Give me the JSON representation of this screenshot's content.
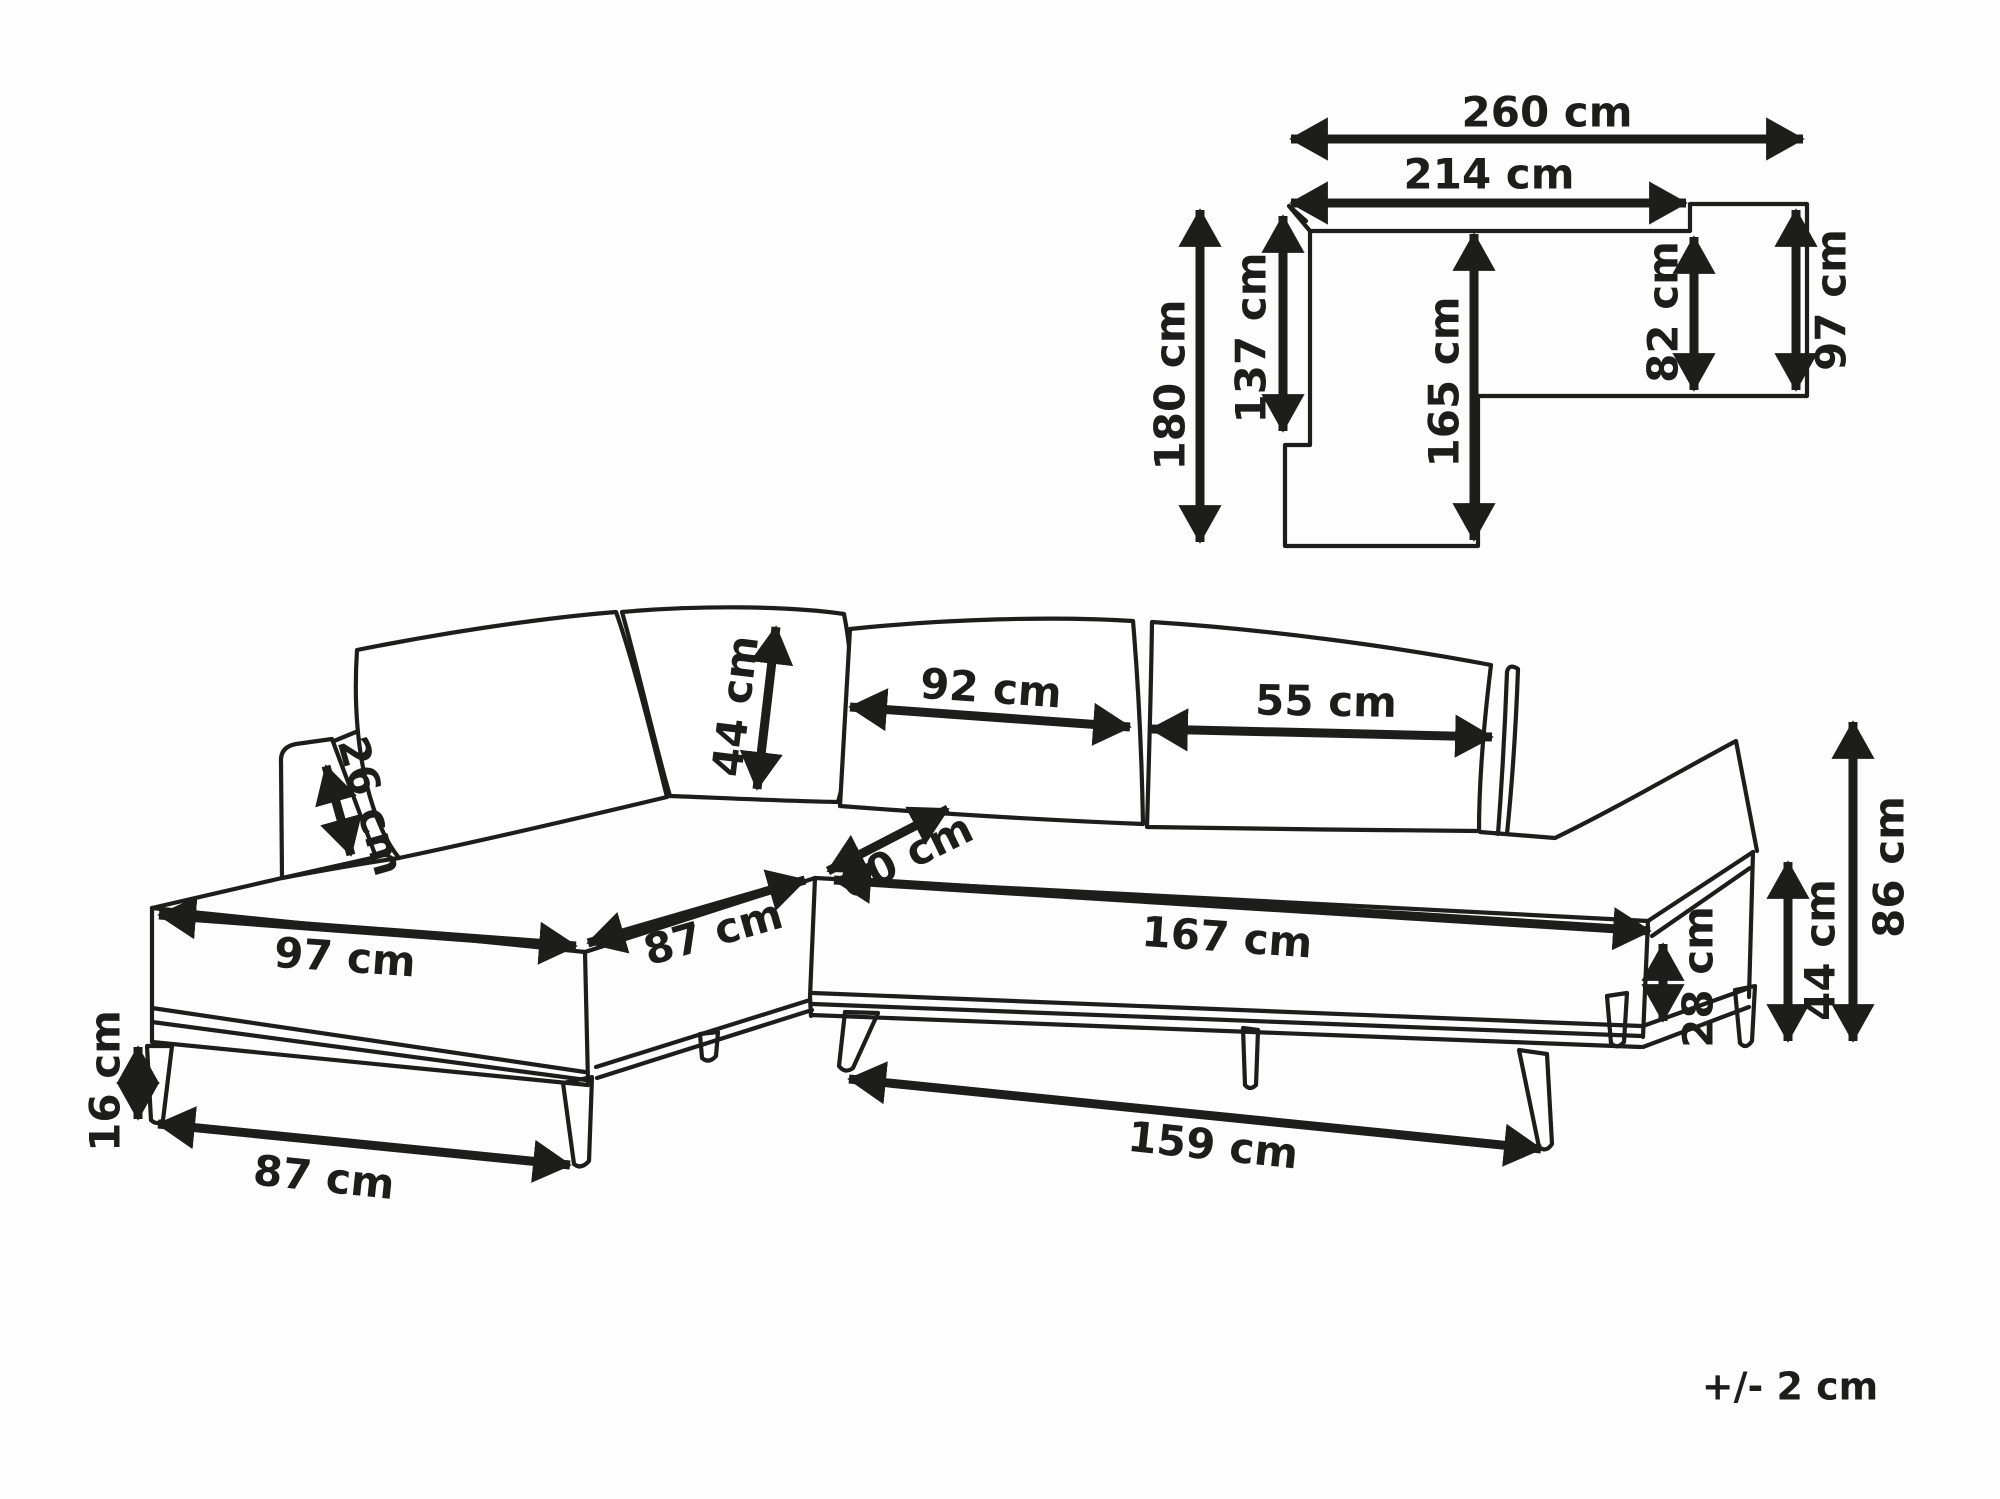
{
  "diagram": {
    "title": "corner-sofa-dimension-diagram",
    "unit": "cm",
    "tolerance": "+/- 2 cm",
    "plan_view": {
      "overall_width": "260 cm",
      "body_width": "214 cm",
      "overall_depth": "180 cm",
      "chaise_back_depth": "137 cm",
      "chaise_inner_depth": "165 cm",
      "right_seat_depth": "82 cm",
      "right_overall_depth": "97 cm"
    },
    "front_view": {
      "back_pillow_height": "44 cm",
      "back_pillow_large_width": "92 cm",
      "back_pillow_small_width": "55 cm",
      "armrest_top_width": "26 cm",
      "corner_seat_depth": "60 cm",
      "chaise_front_width": "97 cm",
      "chaise_side_length": "87 cm",
      "right_seat_length": "167 cm",
      "seat_edge_thickness": "28 cm",
      "seat_height": "44 cm",
      "overall_height": "86 cm",
      "leg_height": "16 cm",
      "base_front_width": "87 cm",
      "base_side_length": "159 cm"
    }
  }
}
